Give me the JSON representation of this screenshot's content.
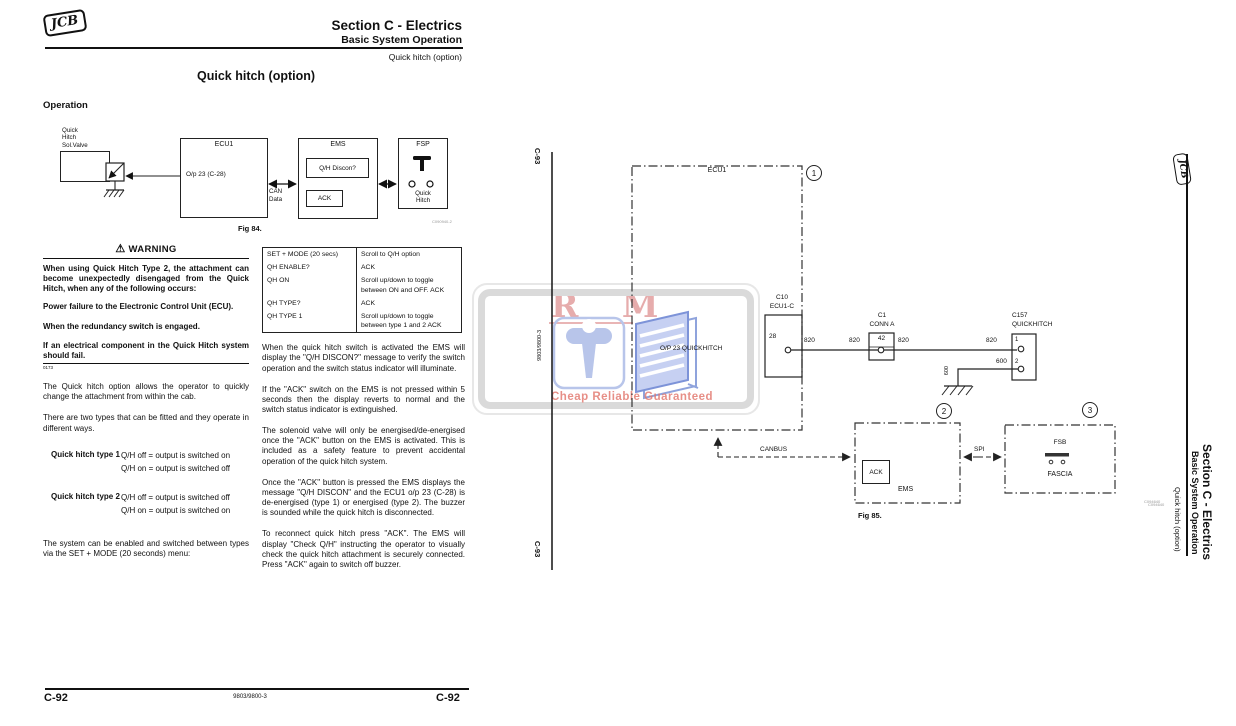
{
  "header": {
    "logo": "JCB",
    "section": "Section C - Electrics",
    "subsection": "Basic System Operation",
    "topic": "Quick hitch (option)",
    "title": "Quick hitch (option)",
    "operation": "Operation"
  },
  "fig84": {
    "solvalve": "Quick\nHitch\nSol.Valve",
    "ecu1": "ECU1",
    "output": "O/p 23 (C-28)",
    "can_data": "CAN\nData",
    "ems": "EMS",
    "qh_discon": "Q/H Discon?",
    "ack": "ACK",
    "fsp": "FSP",
    "quick_hitch": "Quick\nHitch",
    "caption": "Fig 84.",
    "ref": "C090940-2"
  },
  "warning": {
    "title": "WARNING",
    "intro": "When using Quick Hitch Type 2, the attachment can become unexpectedly disengaged from the Quick Hitch, when any of the following occurs:",
    "item1": "Power failure to the Electronic Control Unit (ECU).",
    "item2": "When the redundancy switch is engaged.",
    "item3": "If an electrical component in the Quick Hitch system should fail.",
    "ref": "0173"
  },
  "intro": {
    "p1": "The Quick hitch option allows the operator to quickly change the attachment from within the cab.",
    "p2": "There are two types that can be fitted and they operate in different ways."
  },
  "types": {
    "t1_label": "Quick hitch type 1",
    "t1_line1": "Q/H off = output is switched on",
    "t1_line2": "Q/H on = output is switched off",
    "t2_label": "Quick hitch type 2",
    "t2_line1": "Q/H off = output is switched off",
    "t2_line2": "Q/H on = output is switched on",
    "note": "The system can be enabled and switched between types via the SET + MODE (20 seconds) menu:"
  },
  "menu_table": {
    "rows": [
      {
        "key": "SET + MODE (20 secs)",
        "value": "Scroll to Q/H option"
      },
      {
        "key": "QH ENABLE?",
        "value": "ACK"
      },
      {
        "key": "QH ON",
        "value": "Scroll up/down to toggle between ON and OFF. ACK"
      },
      {
        "key": "QH TYPE?",
        "value": "ACK"
      },
      {
        "key": "QH TYPE 1",
        "value": "Scroll up/down to toggle between type 1 and 2 ACK"
      }
    ]
  },
  "operation_text": {
    "p1": "When the quick hitch switch is activated the EMS will display the \"Q/H DISCON?\" message to verify the switch operation and the switch status indicator will illuminate.",
    "p2": "If the \"ACK\" switch on the EMS is not pressed within 5 seconds then the display reverts to normal and the switch status indicator is extinguished.",
    "p3": "The solenoid valve will only be energised/de-energised once the \"ACK\" button on the EMS is activated. This is included as a safety feature to prevent accidental operation of the quick hitch system.",
    "p4": "Once the \"ACK\" button is pressed the EMS displays the message \"Q/H DISCON\" and the ECU1 o/p 23 (C-28) is de-energised (type 1) or energised (type 2). The buzzer is sounded while the quick hitch is disconnected.",
    "p5": "To reconnect quick hitch press \"ACK\". The EMS will display \"Check Q/H\" instructing the operator to visually check the quick hitch attachment is securely connected. Press \"ACK\" again to switch off buzzer."
  },
  "schematic": {
    "c93": "C-93",
    "part_number": "9803/9800-3",
    "ecu1": "ECU1",
    "n1": "1",
    "n2": "2",
    "n3": "3",
    "op23": "O/P 23 QUICKHITCH",
    "c10": "C10",
    "ecu1_c": "ECU1-C",
    "pin28": "28",
    "w820": "820",
    "w600": "600",
    "c1": "C1",
    "conn_a": "CONN A",
    "pin42": "42",
    "c157": "C157",
    "quickhitch": "QUICKHITCH",
    "pin1": "1",
    "pin2": "2",
    "canbus": "CANBUS",
    "spi": "SPI",
    "ack": "ACK",
    "ems": "EMS",
    "fsb": "FSB",
    "fascia": "FASCIA",
    "caption": "Fig 85.",
    "ref": "C094640"
  },
  "watermark": {
    "letters": "R M",
    "tagline": "Cheap Reliable Guaranteed"
  },
  "sidebar": {
    "logo": "JCB",
    "section": "Section C - Electrics",
    "subsection": "Basic System Operation",
    "topic": "Quick hitch (option)",
    "ref": "C094640"
  },
  "footer": {
    "page": "C-92",
    "part_number": "9803/9800-3"
  }
}
